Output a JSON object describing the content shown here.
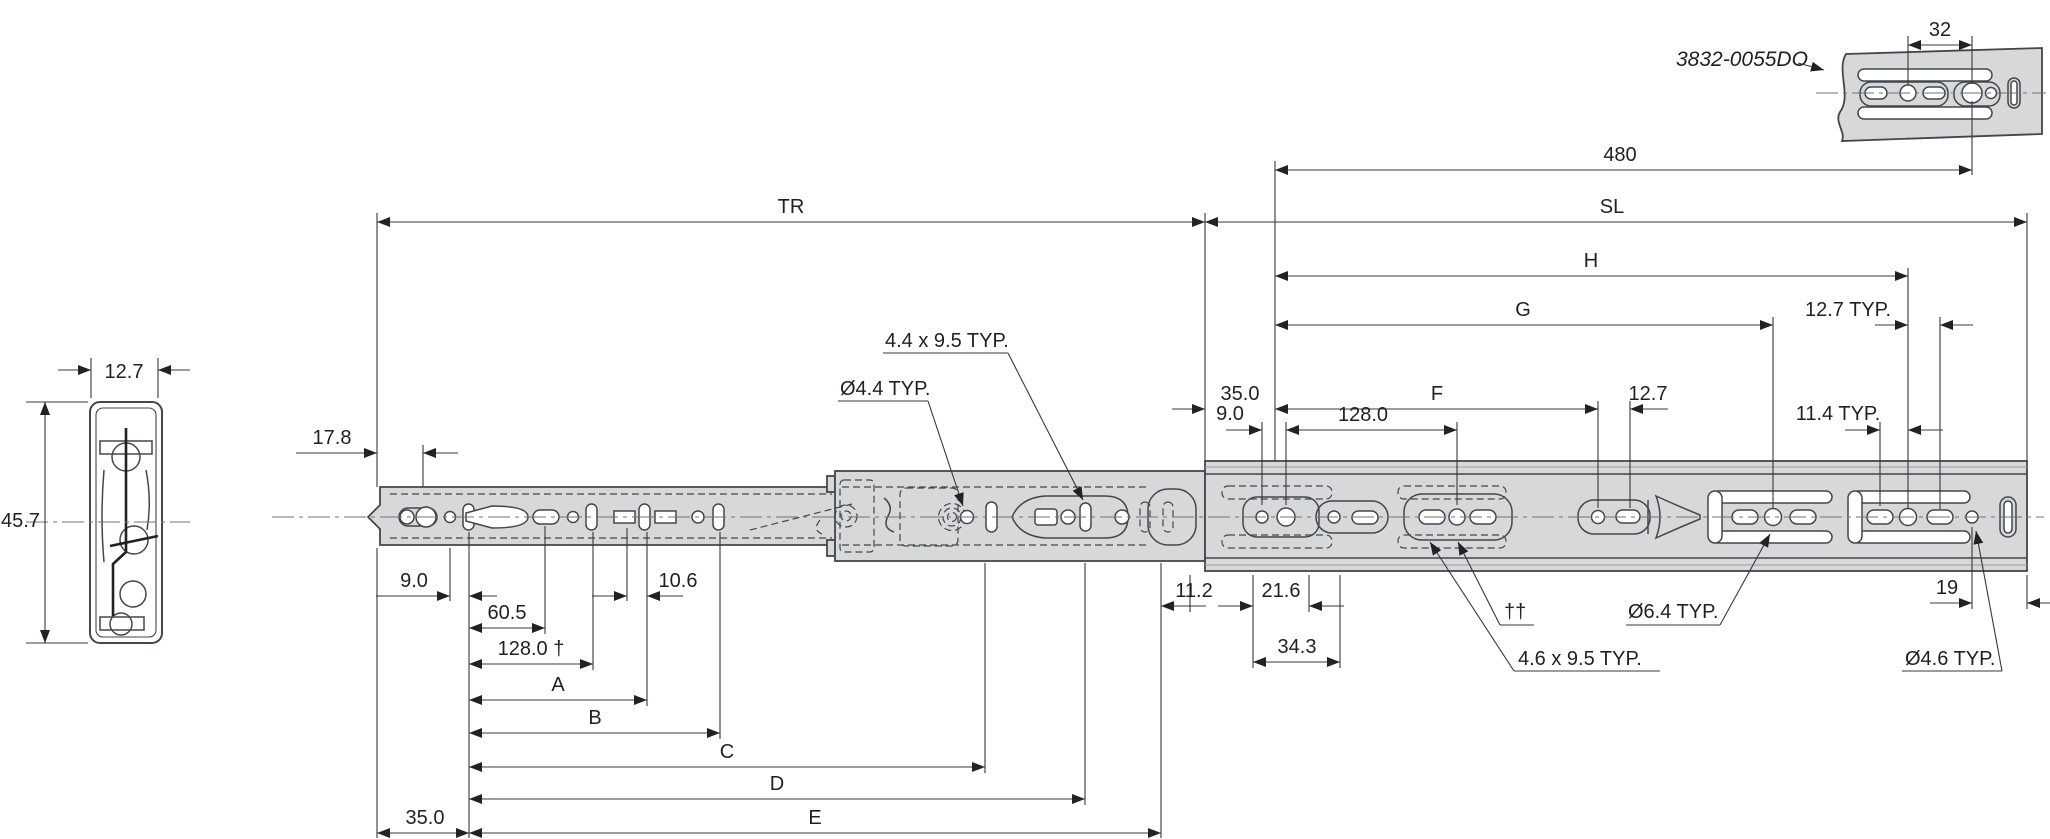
{
  "part": {
    "number": "3832-0055DO"
  },
  "labels": {
    "d32": "32",
    "d480": "480",
    "tr": "TR",
    "sl": "SL",
    "h": "H",
    "g": "G",
    "d127_typ": "12.7 TYP.",
    "f": "F",
    "d127": "12.7",
    "d35_sl": "35.0",
    "d9_sl": "9.0",
    "d128_sl": "128.0",
    "d114_typ": "11.4 TYP.",
    "cs_width": "12.7",
    "cs_height": "45.7",
    "d178": "17.8",
    "slot44": "4.4 x 9.5 TYP.",
    "dia44": "Ø4.4 TYP.",
    "d9": "9.0",
    "d605": "60.5",
    "d106": "10.6",
    "d128_dagger": "128.0 †",
    "a": "A",
    "b": "B",
    "c": "C",
    "d": "D",
    "e": "E",
    "d35": "35.0",
    "d112": "11.2",
    "d216": "21.6",
    "d343": "34.3",
    "daggers": "††",
    "slot46": "4.6 x 9.5 TYP.",
    "dia64": "Ø6.4 TYP.",
    "d19": "19",
    "dia46": "Ø4.6 TYP."
  },
  "colors": {
    "rail_fill": "#d6d8da",
    "outline": "#42474c",
    "dimension": "#35383b",
    "text": "#231f20"
  }
}
